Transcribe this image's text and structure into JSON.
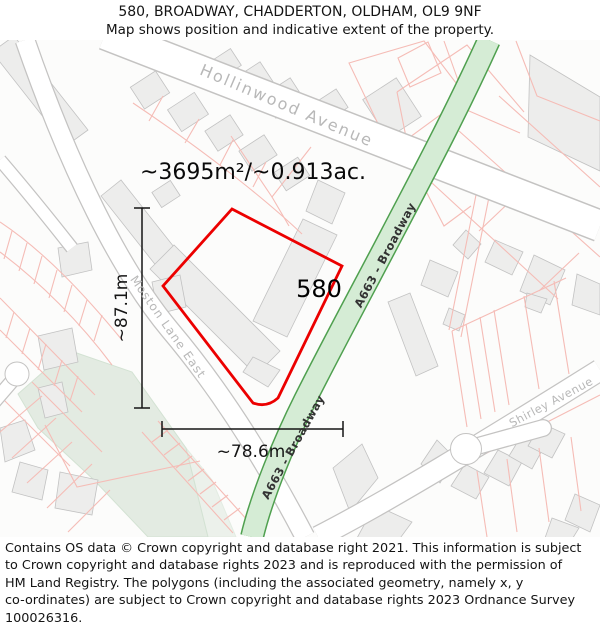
{
  "header": {
    "line1": "580, BROADWAY, CHADDERTON, OLDHAM, OL9 9NF",
    "line2": "Map shows position and indicative extent of the property."
  },
  "map": {
    "area_label": "~3695m²/~0.913ac.",
    "property_number": "580",
    "width_label": "~78.6m",
    "height_label": "~87.1m",
    "streets": {
      "hollinwood": "Hollinwood Avenue",
      "moston": "Moston Lane East",
      "shirley": "Shirley Avenue",
      "a663_upper": "A663 - Broadway",
      "a663_lower": "A663 - Broadway"
    },
    "colors": {
      "property_outline": "#ec0000",
      "a_road_fill": "#d5ecd5",
      "a_road_border": "#4fa04f",
      "park_fill": "#e3ebe2",
      "park_stroke": "#d3e2d3",
      "building_fill": "#ededec",
      "building_stroke": "#c2c2c2",
      "parcel_line": "#f5bcb6",
      "road_casing": "#c4c3c2",
      "street_label": "#b8b8b8",
      "a663_label": "#333333",
      "measure_line": "#151515"
    }
  },
  "footer": {
    "lines": [
      "Contains OS data © Crown copyright and database right 2021. This information is subject",
      "to Crown copyright and database rights 2023 and is reproduced with the permission of",
      "HM Land Registry. The polygons (including the associated geometry, namely x, y",
      "co-ordinates) are subject to Crown copyright and database rights 2023 Ordnance Survey",
      "100026316."
    ]
  }
}
